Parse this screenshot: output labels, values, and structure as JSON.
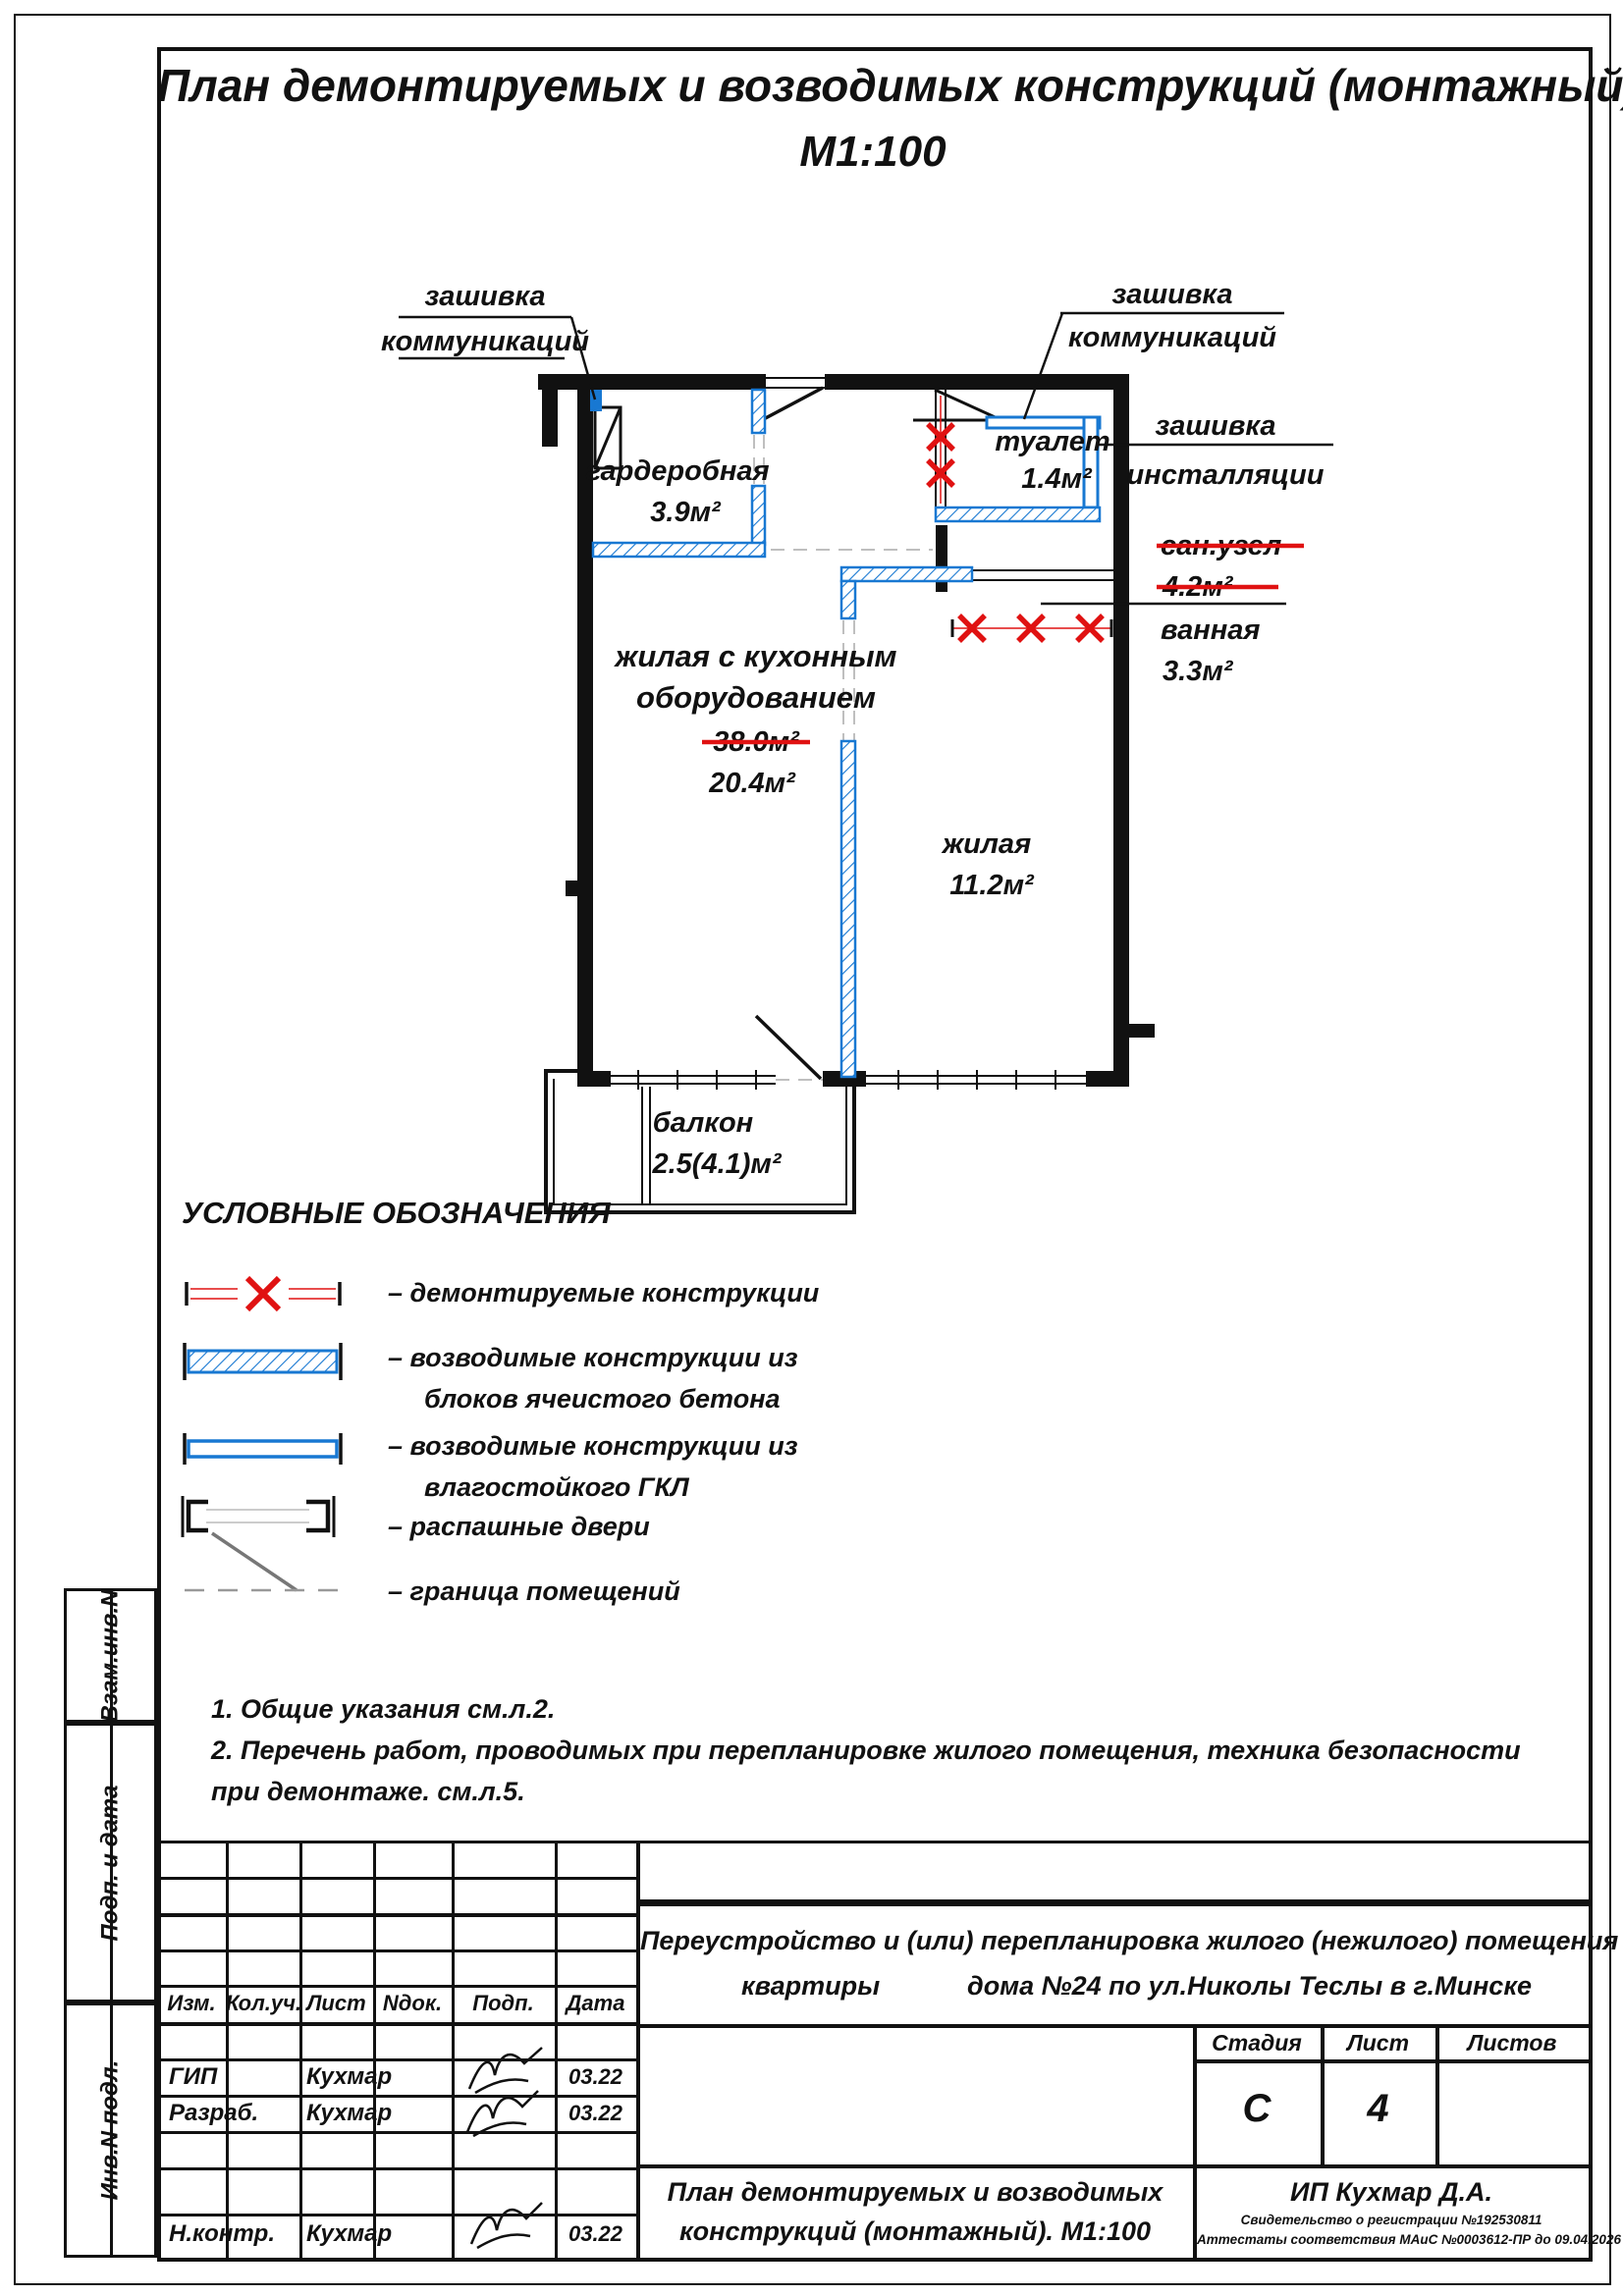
{
  "title": {
    "line1": "План демонтируемых и возводимых конструкций (монтажный).",
    "line2": "М1:100"
  },
  "plan": {
    "callout_left": {
      "line1": "зашивка",
      "line2": "коммуникаций"
    },
    "callout_right": {
      "line1": "зашивка",
      "line2": "коммуникаций"
    },
    "callout_install": {
      "line1": "зашивка",
      "line2": "инсталляции"
    },
    "san_uzel": {
      "name": "сан.узел",
      "area": "4.2м²"
    },
    "bath": {
      "name": "ванная",
      "area": "3.3м²"
    },
    "rooms": {
      "wardrobe": {
        "name": "гардеробная",
        "area": "3.9м²"
      },
      "toilet": {
        "name": "туалет",
        "area": "1.4м²"
      },
      "living_kitchen": {
        "name1": "жилая с кухонным",
        "name2": "оборудованием",
        "area_old": "38.0м²",
        "area_new": "20.4м²"
      },
      "living": {
        "name": "жилая",
        "area": "11.2м²"
      },
      "balcony": {
        "name": "балкон",
        "area": "2.5(4.1)м²"
      }
    }
  },
  "legend": {
    "header": "УСЛОВНЫЕ ОБОЗНАЧЕНИЯ",
    "items": [
      {
        "line1": "–  демонтируемые конструкции",
        "line2": ""
      },
      {
        "line1": "–  возводимые конструкции из",
        "line2": "блоков ячеистого бетона"
      },
      {
        "line1": "–  возводимые конструкции из",
        "line2": "влагостойкого ГКЛ"
      },
      {
        "line1": "–  распашные двери",
        "line2": ""
      },
      {
        "line1": "–  граница помещений",
        "line2": ""
      }
    ]
  },
  "notes": {
    "n1": "1.  Общие указания см.л.2.",
    "n2": "2.  Перечень работ, проводимых при перепланировке жилого помещения, техника безопасности",
    "n3": "при демонтаже. см.л.5."
  },
  "titleblock": {
    "cols": [
      "Изм.",
      "Кол.уч.",
      "Лист",
      "Nдок.",
      "Подп.",
      "Дата"
    ],
    "rows": [
      {
        "role": "ГИП",
        "name": "Кухмар",
        "date": "03.22"
      },
      {
        "role": "Разраб.",
        "name": "Кухмар",
        "date": "03.22"
      },
      {
        "role": "Н.контр.",
        "name": "Кухмар",
        "date": "03.22"
      }
    ],
    "project_line1": "Переустройство и (или) перепланировка жилого (нежилого) помещения",
    "project_word": "квартиры",
    "project_rest": "дома №24  по ул.Николы Теслы в г.Минске",
    "stage_label": "Стадия",
    "sheet_label": "Лист",
    "sheets_label": "Листов",
    "stage": "С",
    "sheet": "4",
    "sheets": "",
    "doc_title1": "План демонтируемых и возводимых",
    "doc_title2": "конструкций (монтажный). М1:100",
    "org": "ИП Кухмар Д.А.",
    "cert1": "Свидетельство о регистрации  №192530811",
    "cert2": "Аттестаты соответствия МАиС  №0003612-ПР до  09.04.2026",
    "sidebar": [
      "Взам.инв.N",
      "Подп. и дата",
      "Инв.N подл."
    ]
  },
  "colors": {
    "blue": "#1878d2",
    "red": "#e01212",
    "black": "#111111"
  }
}
